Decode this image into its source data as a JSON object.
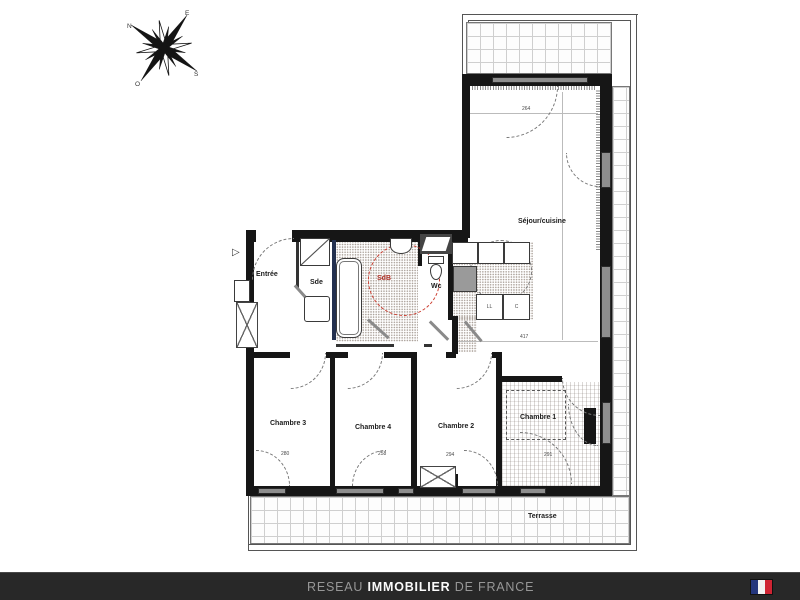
{
  "compass": {
    "n": "N",
    "e": "E",
    "s": "S",
    "o": "O"
  },
  "icons": {
    "entry_arrow": "▷"
  },
  "plan": {
    "rooms": {
      "entree": "Entrée",
      "sde": "Sde",
      "sdb": "SdB",
      "wc": "Wc",
      "sejour": "Séjour/cuisine",
      "chambre1": "Chambre 1",
      "chambre2": "Chambre 2",
      "chambre3": "Chambre 3",
      "chambre4": "Chambre 4",
      "terrasse": "Terrasse"
    },
    "kitchen_units": {
      "ll": "LL",
      "c": "C"
    },
    "dimensions": {
      "sejour_top": "264",
      "kitchen_bottom": "417",
      "chambre3_width": "280",
      "chambre4_width": "258",
      "chambre2_width": "294",
      "chambre1_width": "291"
    },
    "colors": {
      "wall": "#161616",
      "window": "#8e8e8e",
      "accessibility_circle": "#cc3b2e",
      "sdb_label": "#b03228"
    }
  },
  "footer": {
    "agency_light1": "RESEAU",
    "agency_bold": "IMMOBILIER",
    "agency_light2": "DE FRANCE",
    "background": "#282828",
    "flag": {
      "blue": "#24367d",
      "white": "#f2f2f2",
      "red": "#cf2433"
    }
  }
}
